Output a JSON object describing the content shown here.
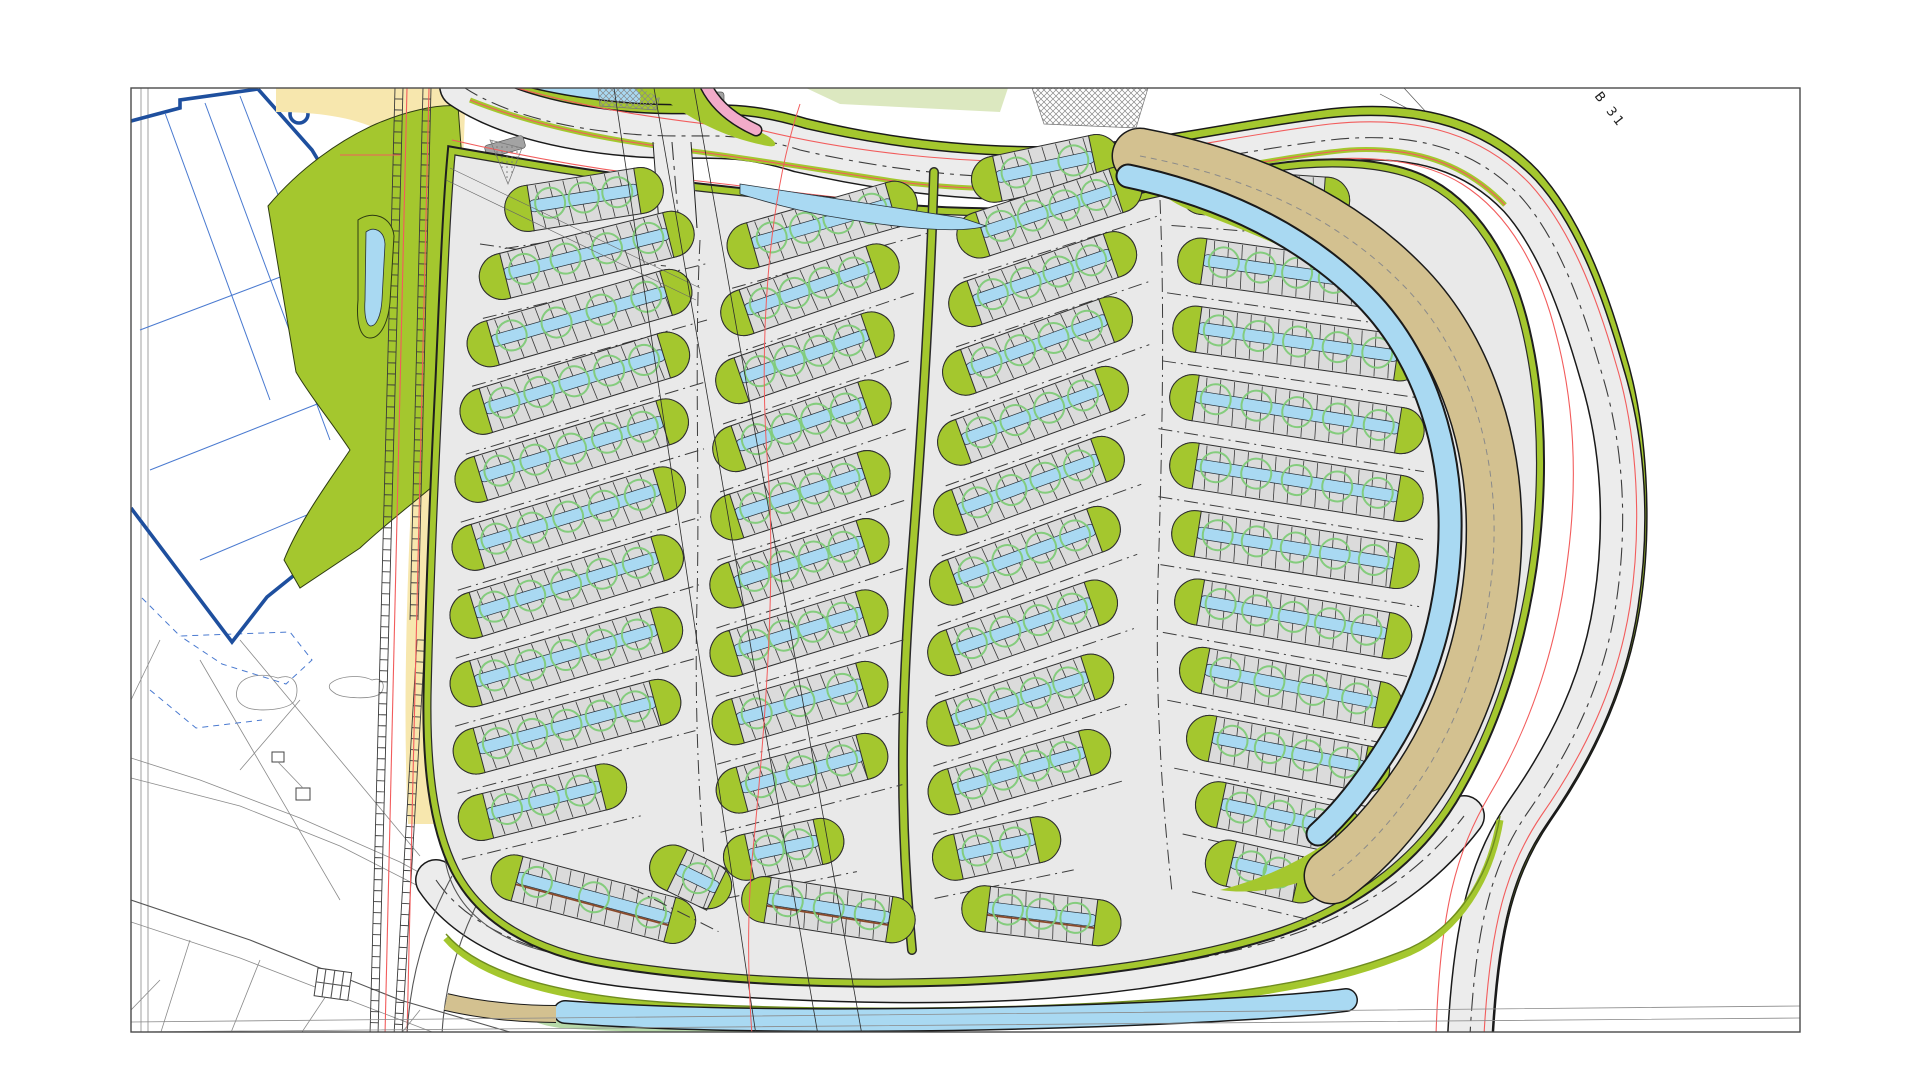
{
  "labels": {
    "b31": "B 31"
  },
  "colors": {
    "paper": "#ffffff",
    "frame": "#4a4a4a",
    "ink": "#1a1a1a",
    "dash": "#3c3c3c",
    "road": "#ececec",
    "pad": "#e9e9e9",
    "stall": "#dbdbdb",
    "stallLine": "#3a3a3a",
    "green": "#a4c72e",
    "greenDark": "#6f8c1f",
    "water": "#a9d9f2",
    "tree": "#7fcb78",
    "starTree": "#69bf5f",
    "tan": "#d3c190",
    "tanLine": "#8a7a4a",
    "sage": "#b7d9a9",
    "lime": "#dce8c0",
    "pink": "#f2abc9",
    "red": "#f25c5c",
    "navy": "#1e4f9e",
    "blueThin": "#4a7ad0",
    "ctx": "#8a8a8a",
    "sand": "#f7e7ae",
    "brown": "#8a4a2a"
  },
  "parking": {
    "columns": [
      {
        "id": "west-outer",
        "rows": [
          [
            505,
            212,
            160,
            -9,
            {
              "t": 3
            }
          ],
          [
            480,
            282,
            220,
            -14
          ],
          [
            468,
            350,
            232,
            -16
          ],
          [
            461,
            418,
            238,
            -17
          ],
          [
            456,
            486,
            242,
            -17
          ],
          [
            453,
            554,
            242,
            -17
          ],
          [
            451,
            622,
            242,
            -17
          ],
          [
            451,
            690,
            240,
            -16
          ],
          [
            454,
            757,
            234,
            -15
          ],
          [
            459,
            823,
            172,
            -14,
            {
              "t": 3,
              "cl": 30
            }
          ],
          [
            492,
            872,
            210,
            15,
            {
              "br": 1,
              "t": 3
            }
          ]
        ]
      },
      {
        "id": "west-inner",
        "rows": [
          [
            728,
            252,
            196,
            -16
          ],
          [
            722,
            320,
            186,
            -19
          ],
          [
            717,
            388,
            186,
            -19
          ],
          [
            714,
            456,
            186,
            -19
          ],
          [
            712,
            524,
            186,
            -18
          ],
          [
            711,
            592,
            186,
            -18
          ],
          [
            711,
            660,
            184,
            -17
          ],
          [
            713,
            728,
            181,
            -16
          ],
          [
            717,
            796,
            176,
            -15
          ],
          [
            724,
            862,
            122,
            -12,
            {
              "t": 2
            }
          ],
          [
            742,
            896,
            175,
            9,
            {
              "br": 1,
              "t": 3
            }
          ],
          [
            652,
            858,
            86,
            26,
            {
              "t": 1,
              "cl": 28,
              "cr": 14
            }
          ]
        ]
      },
      {
        "id": "east-inner",
        "rows": [
          [
            972,
            184,
            150,
            -12,
            {
              "t": 2
            }
          ],
          [
            958,
            242,
            192,
            -18
          ],
          [
            950,
            311,
            196,
            -19
          ],
          [
            944,
            380,
            199,
            -20
          ],
          [
            939,
            450,
            200,
            -20
          ],
          [
            935,
            520,
            200,
            -20
          ],
          [
            931,
            590,
            200,
            -20
          ],
          [
            929,
            660,
            198,
            -19
          ],
          [
            928,
            730,
            194,
            -18
          ],
          [
            929,
            798,
            188,
            -16
          ],
          [
            933,
            862,
            130,
            -12,
            {
              "t": 2
            }
          ],
          [
            962,
            906,
            160,
            7,
            {
              "br": 1,
              "t": 3
            }
          ]
        ]
      },
      {
        "id": "east-outer",
        "rows": [
          [
            1180,
            190,
            170,
            4,
            {
              "t": 3
            }
          ],
          [
            1178,
            258,
            240,
            8
          ],
          [
            1173,
            326,
            252,
            8
          ],
          [
            1170,
            394,
            257,
            9
          ],
          [
            1170,
            462,
            256,
            9
          ],
          [
            1172,
            530,
            250,
            9
          ],
          [
            1175,
            598,
            240,
            10
          ],
          [
            1180,
            666,
            226,
            11
          ],
          [
            1187,
            734,
            206,
            11
          ],
          [
            1196,
            800,
            170,
            12,
            {
              "t": 3
            }
          ],
          [
            1206,
            858,
            120,
            13,
            {
              "t": 2
            }
          ]
        ]
      }
    ],
    "accessible": [
      {
        "x": 404,
        "y": 206,
        "ang": -38,
        "len": 92,
        "n": 4
      },
      {
        "x": 388,
        "y": 260,
        "ang": -52,
        "len": 66,
        "n": 2,
        "bike": true
      }
    ]
  },
  "flora": {
    "star_trees_green": [
      [
        768,
        114
      ],
      [
        798,
        122
      ],
      [
        826,
        129
      ],
      [
        854,
        135
      ],
      [
        882,
        140
      ],
      [
        910,
        144
      ],
      [
        836,
        108
      ],
      [
        806,
        100
      ]
    ],
    "star_cluster": [
      [
        372,
        180
      ],
      [
        394,
        170
      ],
      [
        382,
        200
      ],
      [
        404,
        194
      ],
      [
        368,
        226
      ],
      [
        392,
        222
      ],
      [
        408,
        246
      ],
      [
        380,
        250
      ],
      [
        398,
        276
      ],
      [
        372,
        292
      ],
      [
        404,
        300
      ],
      [
        386,
        320
      ]
    ],
    "star_trees_gray": [
      [
        203,
        668
      ],
      [
        191,
        699
      ],
      [
        204,
        722
      ]
    ]
  },
  "survey_circles": [
    [
      1668,
      992,
      5
    ],
    [
      1694,
      974,
      5
    ],
    [
      1710,
      1012,
      5
    ],
    [
      1652,
      1008,
      4
    ]
  ]
}
